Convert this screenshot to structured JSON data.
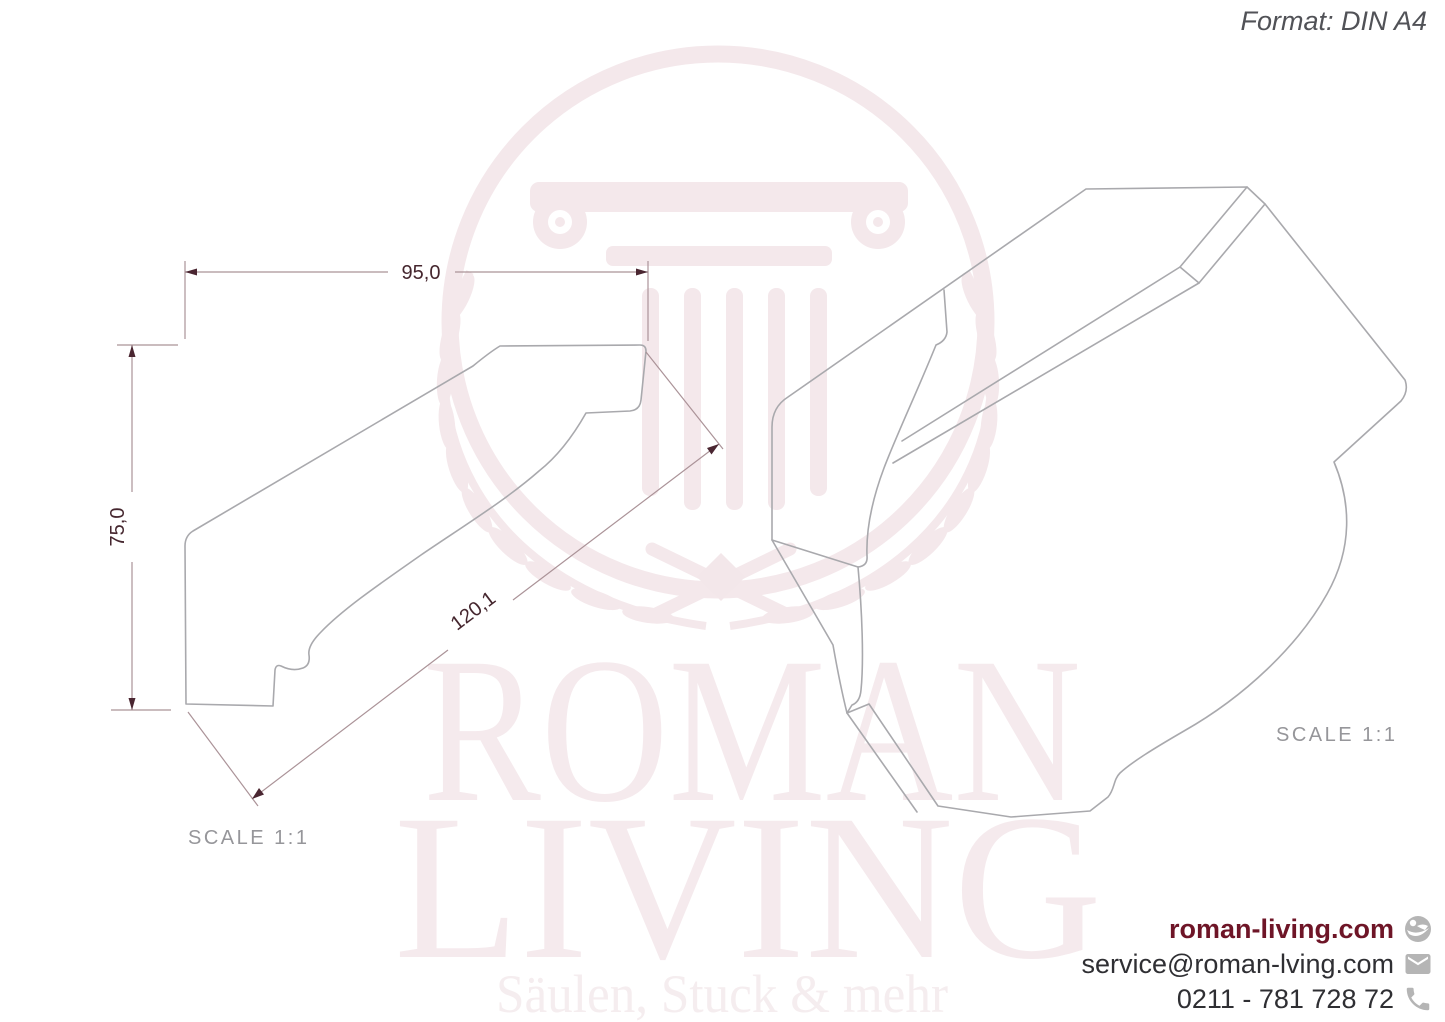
{
  "page": {
    "format_label": "Format: DIN A4"
  },
  "left_drawing": {
    "type": "2D cross-section profile of crown molding",
    "width_dim": "95,0",
    "height_dim": "75,0",
    "diagonal_dim": "120,1",
    "scale_label": "SCALE  1:1"
  },
  "right_drawing": {
    "type": "3D perspective view of crown molding",
    "scale_label": "SCALE  1:1"
  },
  "watermark": {
    "brand_line1": "ROMAN",
    "brand_line2": "LIVING",
    "tagline": "Säulen, Stuck & mehr"
  },
  "contact": {
    "website": "roman-living.com",
    "email": "service@roman-lving.com",
    "phone": "0211 - 781 728 72"
  },
  "colors": {
    "background": "#ffffff",
    "brand_red": "#6e1527",
    "dimension_text": "#45262e",
    "dimension_line": "#ab9398",
    "arrowhead": "#4a2631",
    "drawing_outline": "#a9a9ad",
    "watermark_pink": "#f4e8eb",
    "scale_text": "#96969a",
    "format_text": "#515257",
    "icon_gray": "#b5b5b5",
    "contact_text": "#2f2f33"
  }
}
